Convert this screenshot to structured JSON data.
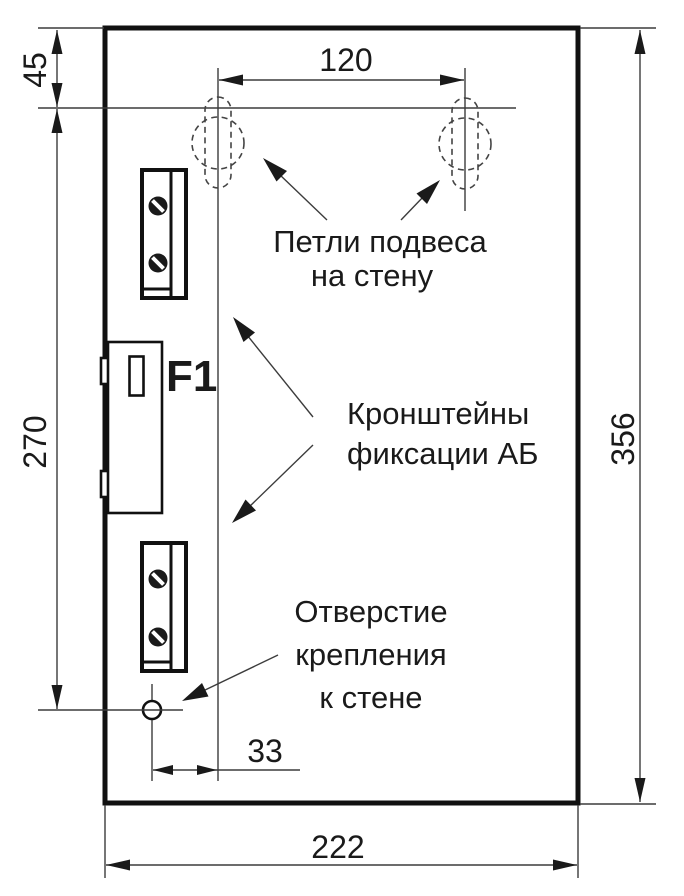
{
  "colors": {
    "ink": "#1a1a1a",
    "thick_line": "#111111",
    "thin_line": "#3c3c3c",
    "background": "#ffffff"
  },
  "dimensions": {
    "loop_offset_top": "45",
    "loop_spacing": "120",
    "hole_vertical_offset": "270",
    "panel_height": "356",
    "hole_horizontal_offset": "33",
    "panel_width": "222"
  },
  "components": {
    "fuse_label": "F1"
  },
  "annotations": {
    "hanging_loops": {
      "line1": "Петли подвеса",
      "line2": "на стену"
    },
    "battery_brackets": {
      "line1": "Кронштейны",
      "line2": "фиксации АБ"
    },
    "mount_hole": {
      "line1": "Отверстие",
      "line2": "крепления",
      "line3": "к стене"
    }
  }
}
